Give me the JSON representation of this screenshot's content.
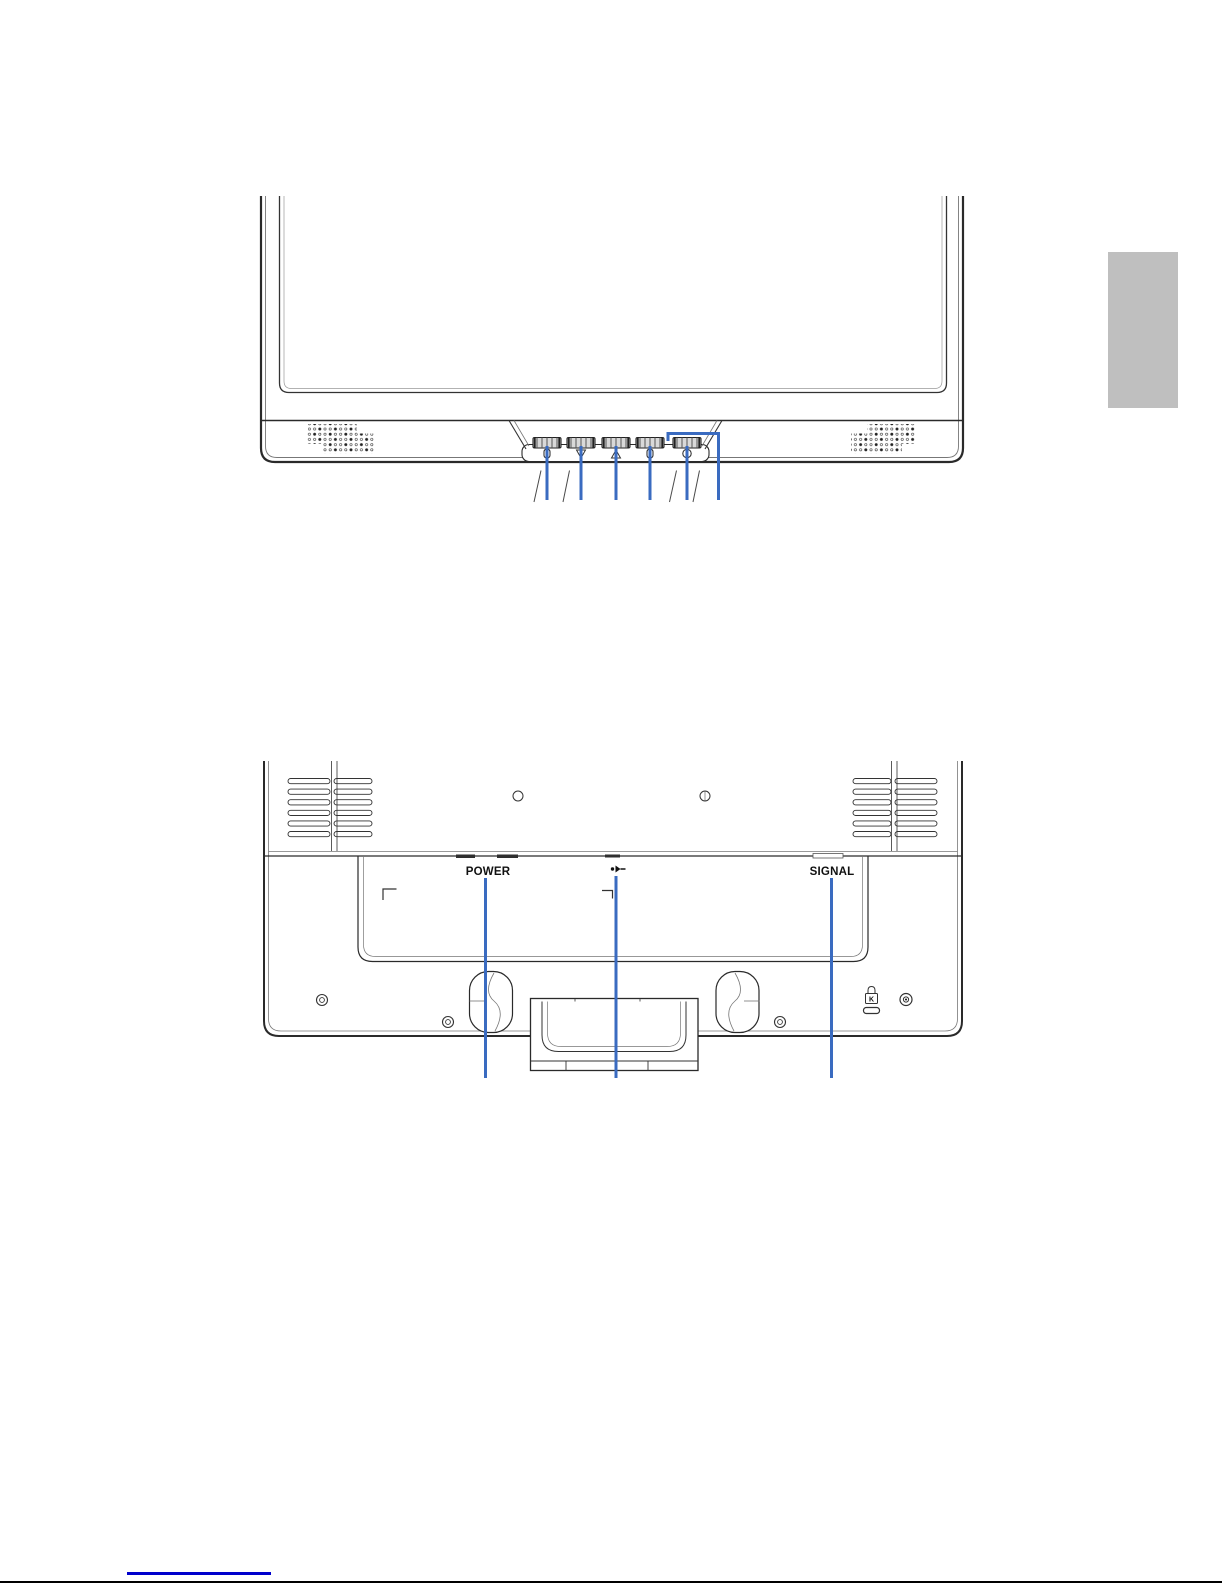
{
  "page": {
    "background": "#ffffff"
  },
  "side_tab": {
    "color": "#bfbfbf"
  },
  "front_view": {
    "figure": "monitor-front-bottom-view",
    "callout_color": "#3a6bc0",
    "button_icons": [
      "menu",
      "scroll-down",
      "scroll-up",
      "select",
      "power"
    ],
    "button_count": 5,
    "callout_count": 6
  },
  "rear_view": {
    "figure": "monitor-rear-view",
    "callout_color": "#3a6bc0",
    "power_label": "POWER",
    "signal_label": "SIGNAL",
    "kensington_label": "K",
    "port_icons": [
      "audio-line-in-icon",
      "kensington-lock-icon"
    ],
    "callout_count": 3
  },
  "footer": {
    "link_underline_color": "#0000cc",
    "rule_color": "#000000"
  }
}
